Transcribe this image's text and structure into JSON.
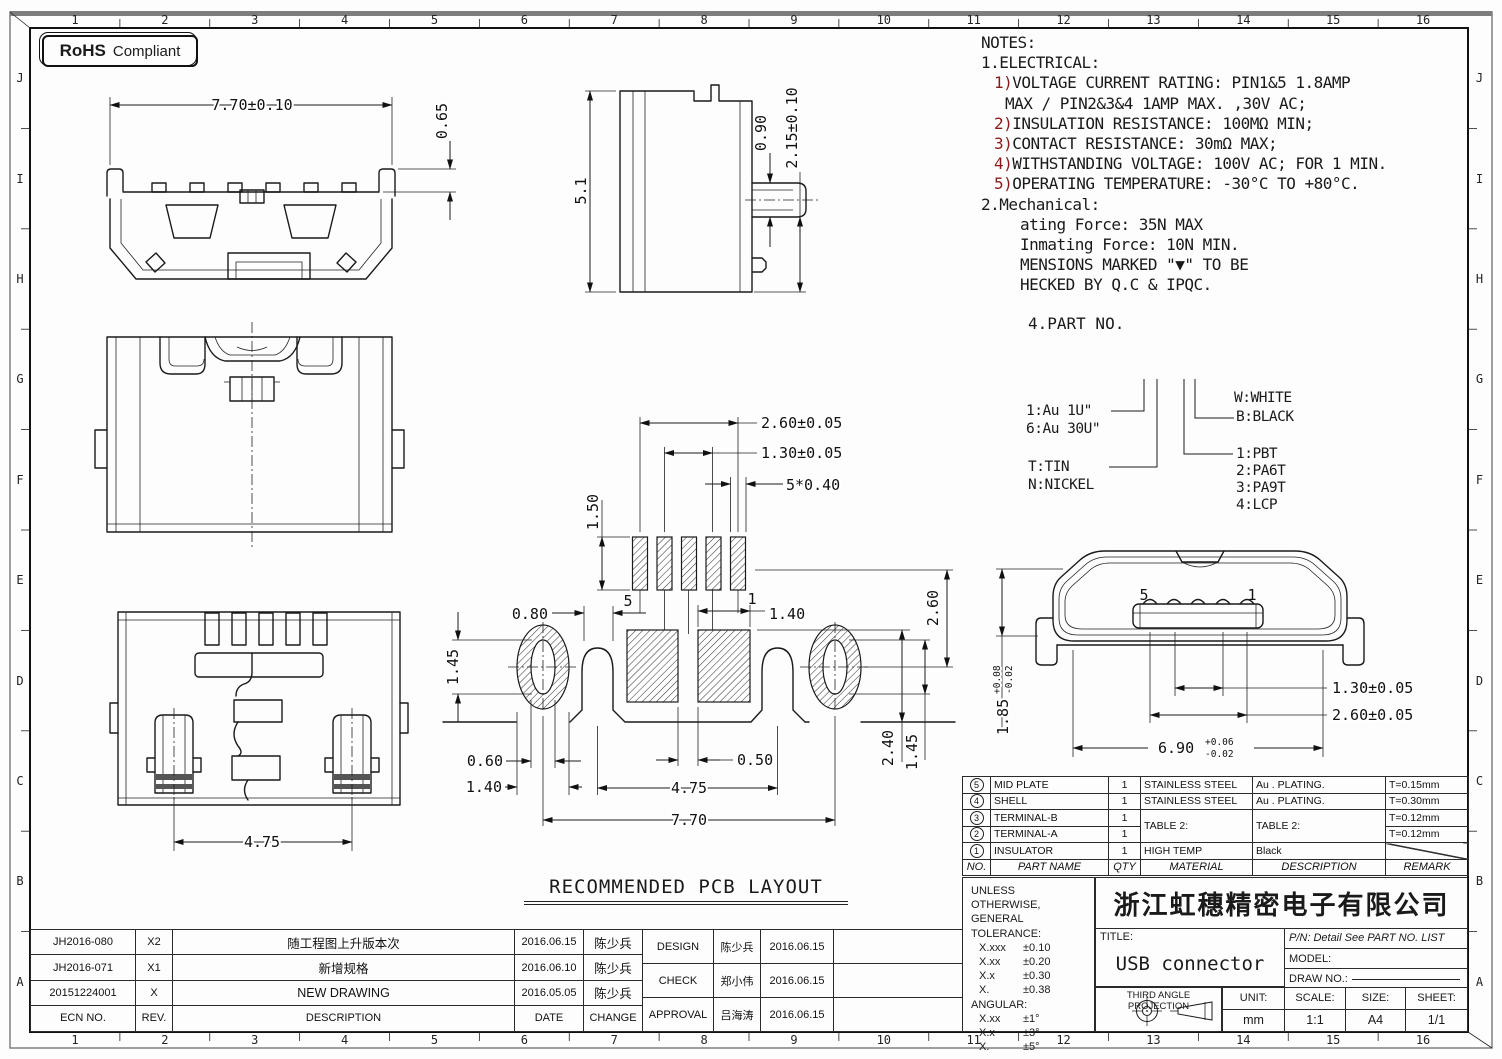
{
  "border": {
    "top": [
      "1",
      "2",
      "3",
      "4",
      "5",
      "6",
      "7",
      "8",
      "9",
      "10",
      "11",
      "12",
      "13",
      "14",
      "15",
      "16"
    ],
    "side": [
      "J",
      "I",
      "H",
      "G",
      "F",
      "E",
      "D",
      "C",
      "B",
      "A"
    ]
  },
  "rohs": {
    "brand": "RoHS",
    "label": "Compliant"
  },
  "notes": {
    "title": "NOTES:",
    "sec1": "1.ELECTRICAL:",
    "e1p": "1)",
    "e1": "VOLTAGE CURRENT RATING: PIN1&5 1.8AMP",
    "e1b": "MAX / PIN2&3&4 1AMP MAX. ,30V AC;",
    "e2p": "2)",
    "e2": "INSULATION RESISTANCE: 100MΩ MIN;",
    "e3p": "3)",
    "e3": "CONTACT RESISTANCE: 30mΩ MAX;",
    "e4p": "4)",
    "e4": "WITHSTANDING VOLTAGE: 100V AC; FOR 1 MIN.",
    "e5p": "5)",
    "e5": "OPERATING TEMPERATURE: -30°C TO +80°C.",
    "sec2": "2.Mechanical:",
    "m1": "ating Force: 35N MAX",
    "m2": "Inmating Force: 10N MIN.",
    "m3": "MENSIONS MARKED \"▼\" TO BE",
    "m4": "HECKED BY Q.C & IPQC.",
    "sec4": "4.PART NO."
  },
  "part_no": {
    "au1": "1:Au 1U\"",
    "au30": "6:Au 30U\"",
    "tin": "T:TIN",
    "nickel": "N:NICKEL",
    "white": "W:WHITE",
    "black": "B:BLACK",
    "pbt": "1:PBT",
    "pa6t": "2:PA6T",
    "pa9t": "3:PA9T",
    "lcp": "4:LCP"
  },
  "front_view": {
    "width": "7.70±0.10",
    "tab": "0.65"
  },
  "side_view": {
    "height": "5.1",
    "pad": "0.90",
    "offset": "2.15±0.10"
  },
  "bottom_view": {
    "span": "4.75"
  },
  "pcb": {
    "title": "RECOMMENDED PCB LAYOUT",
    "pin_span": "2.60±0.05",
    "pin_pitch": "1.30±0.05",
    "pad_w": "5*0.40",
    "pad_l": "1.50",
    "notch": "0.80",
    "slot_h": "1.45",
    "slot_w": "0.60",
    "hole_w": "1.40",
    "gap": "0.50",
    "pad_sq": "1.40",
    "leg_span": "4.75",
    "hole_span": "7.70",
    "row_off": "2.60",
    "sq_h": "2.40",
    "slot_h2": "1.45",
    "pin5": "5",
    "pin1": "1"
  },
  "mating": {
    "h": "1.85",
    "h_tol_u": "+0.08",
    "h_tol_l": "-0.02",
    "pitch": "1.30±0.05",
    "span": "2.60±0.05",
    "w": "6.90",
    "w_tol_u": "+0.06",
    "w_tol_l": "-0.02",
    "pin5": "5",
    "pin1": "1"
  },
  "parts_table": {
    "h_no": "NO.",
    "h_name": "PART NAME",
    "h_qty": "QTY",
    "h_mat": "MATERIAL",
    "h_desc": "DESCRIPTION",
    "h_rem": "REMARK",
    "rows": [
      {
        "no": "5",
        "name": "MID PLATE",
        "qty": "1",
        "mat": "STAINLESS STEEL",
        "desc": "Au . PLATING.",
        "rem": "T=0.15mm"
      },
      {
        "no": "4",
        "name": "SHELL",
        "qty": "1",
        "mat": "STAINLESS STEEL",
        "desc": "Au . PLATING.",
        "rem": "T=0.30mm"
      },
      {
        "no": "3",
        "name": "TERMINAL-B",
        "qty": "1",
        "mat": "TABLE 2:",
        "desc": "TABLE 2:",
        "rem": "T=0.12mm"
      },
      {
        "no": "2",
        "name": "TERMINAL-A",
        "qty": "1",
        "rem": "T=0.12mm"
      },
      {
        "no": "1",
        "name": "INSULATOR",
        "qty": "1",
        "mat": "HIGH TEMP",
        "desc": "Black",
        "rem": ""
      }
    ]
  },
  "tolerance": {
    "l1": "UNLESS OTHERWISE,",
    "l2": "GENERAL TOLERANCE:",
    "r1a": "X.xxx",
    "r1b": "±0.10",
    "r2a": "X.xx",
    "r2b": "±0.20",
    "r3a": "X.x",
    "r3b": "±0.30",
    "r4a": "X.",
    "r4b": "±0.38",
    "ang": "ANGULAR:",
    "a1a": "X.xx",
    "a1b": "±1°",
    "a2a": "X.x",
    "a2b": "±3°",
    "a3a": "X.",
    "a3b": "±5°"
  },
  "title_block": {
    "company": "浙江虹穗精密电子有限公司",
    "title_label": "TITLE:",
    "title": "USB connector",
    "pn": "P/N: Detail See PART NO. LIST",
    "model_label": "MODEL:",
    "draw_label": "DRAW NO.:",
    "projection": "THIRD ANGLE PROJECTION",
    "unit_label": "UNIT:",
    "unit": "mm",
    "scale_label": "SCALE:",
    "scale": "1:1",
    "size_label": "SIZE:",
    "size": "A4",
    "sheet_label": "SHEET:",
    "sheet": "1/1"
  },
  "revisions": {
    "h_ecn": "ECN NO.",
    "h_rev": "REV.",
    "h_desc": "DESCRIPTION",
    "h_date": "DATE",
    "h_chg": "CHANGE",
    "rows": [
      {
        "ecn": "JH2016-080",
        "rev": "X2",
        "desc": "随工程图上升版本次",
        "date": "2016.06.15",
        "chg": "陈少兵"
      },
      {
        "ecn": "JH2016-071",
        "rev": "X1",
        "desc": "新增规格",
        "date": "2016.06.10",
        "chg": "陈少兵"
      },
      {
        "ecn": "20151224001",
        "rev": "X",
        "desc": "NEW DRAWING",
        "date": "2016.05.05",
        "chg": "陈少兵"
      }
    ]
  },
  "approvals": {
    "rows": [
      {
        "role": "DESIGN",
        "name": "陈少兵",
        "date": "2016.06.15"
      },
      {
        "role": "CHECK",
        "name": "郑小伟",
        "date": "2016.06.15"
      },
      {
        "role": "APPROVAL",
        "name": "吕海涛",
        "date": "2016.06.15"
      }
    ]
  }
}
